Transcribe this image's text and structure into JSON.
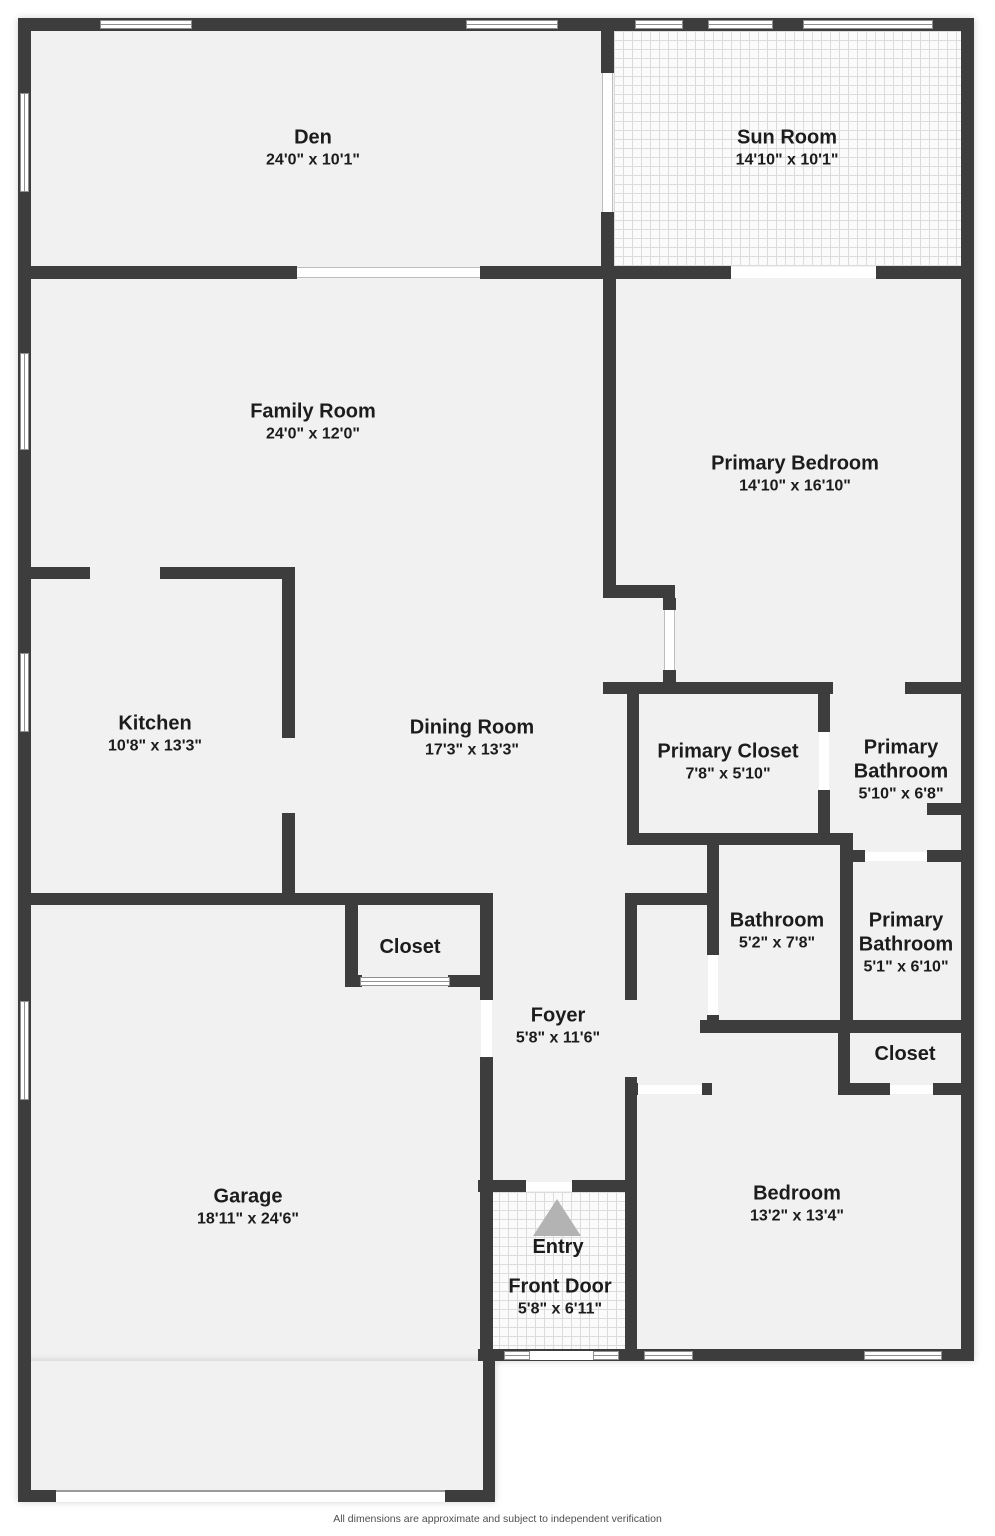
{
  "disclaimer": "All dimensions are approximate and subject to independent verification",
  "colors": {
    "wall": "#3d3d3d",
    "floor": "#f1f1f1",
    "arrow": "#b3b3b3",
    "text": "#1c1c1c"
  },
  "rooms": {
    "den": {
      "name": "Den",
      "dims": "24'0\" x 10'1\""
    },
    "sun_room": {
      "name": "Sun Room",
      "dims": "14'10\" x 10'1\""
    },
    "family_room": {
      "name": "Family Room",
      "dims": "24'0\" x 12'0\""
    },
    "primary_bedroom": {
      "name": "Primary Bedroom",
      "dims": "14'10\" x 16'10\""
    },
    "kitchen": {
      "name": "Kitchen",
      "dims": "10'8\" x 13'3\""
    },
    "dining_room": {
      "name": "Dining Room",
      "dims": "17'3\" x 13'3\""
    },
    "primary_closet": {
      "name": "Primary Closet",
      "dims": "7'8\" x 5'10\""
    },
    "primary_bathroom_1": {
      "name": "Primary Bathroom",
      "dims": "5'10\" x 6'8\""
    },
    "bathroom": {
      "name": "Bathroom",
      "dims": "5'2\" x 7'8\""
    },
    "primary_bathroom_2": {
      "name": "Primary Bathroom",
      "dims": "5'1\" x 6'10\""
    },
    "closet_hall": {
      "name": "Closet"
    },
    "foyer": {
      "name": "Foyer",
      "dims": "5'8\" x 11'6\""
    },
    "closet_bedroom": {
      "name": "Closet"
    },
    "garage": {
      "name": "Garage",
      "dims": "18'11\" x 24'6\""
    },
    "entry": {
      "name": "Entry"
    },
    "front_door": {
      "name": "Front Door",
      "dims": "5'8\" x 6'11\""
    },
    "bedroom": {
      "name": "Bedroom",
      "dims": "13'2\" x 13'4\""
    }
  }
}
